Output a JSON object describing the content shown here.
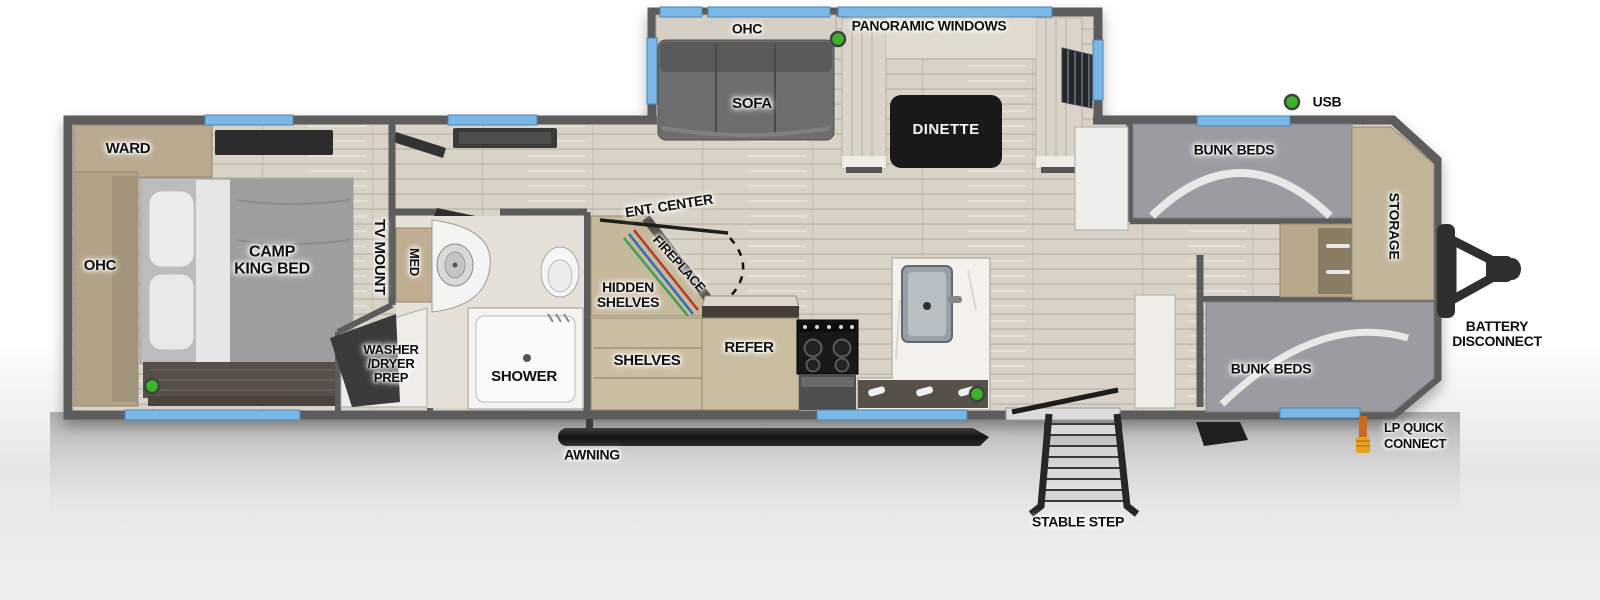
{
  "floorplan": {
    "bedroom": {
      "ward": "WARD",
      "ohc": "OHC",
      "bed": "CAMP\nKING BED",
      "tv_mount": "TV MOUNT"
    },
    "bathroom": {
      "med": "MED",
      "washer_dryer": "WASHER\n/DRYER\nPREP",
      "shower": "SHOWER"
    },
    "living_area": {
      "ent_center": "ENT. CENTER",
      "fireplace": "FIREPLACE",
      "hidden_shelves": "HIDDEN\nSHELVES",
      "shelves": "SHELVES",
      "refer": "REFER",
      "ohc": "OHC",
      "sofa": "SOFA",
      "panoramic_windows": "PANORAMIC WINDOWS",
      "dinette": "DINETTE"
    },
    "bunk_room": {
      "bunk_beds_top": "BUNK BEDS",
      "bunk_beds_bottom": "BUNK BEDS",
      "storage": "STORAGE"
    },
    "exterior": {
      "usb": "USB",
      "battery_disconnect": "BATTERY\nDISCONNECT",
      "lp_quick_connect": "LP QUICK\nCONNECT",
      "awning": "AWNING",
      "stable_step": "STABLE STEP"
    }
  },
  "colors": {
    "wall_gray": "#5c5c5c",
    "window_blue": "#79b7e6",
    "indicator_green": "#3db32a",
    "lp_orange": "#e2921f",
    "dinette_table_black": "#191919",
    "cabinet_tan": "#c6b89b"
  }
}
